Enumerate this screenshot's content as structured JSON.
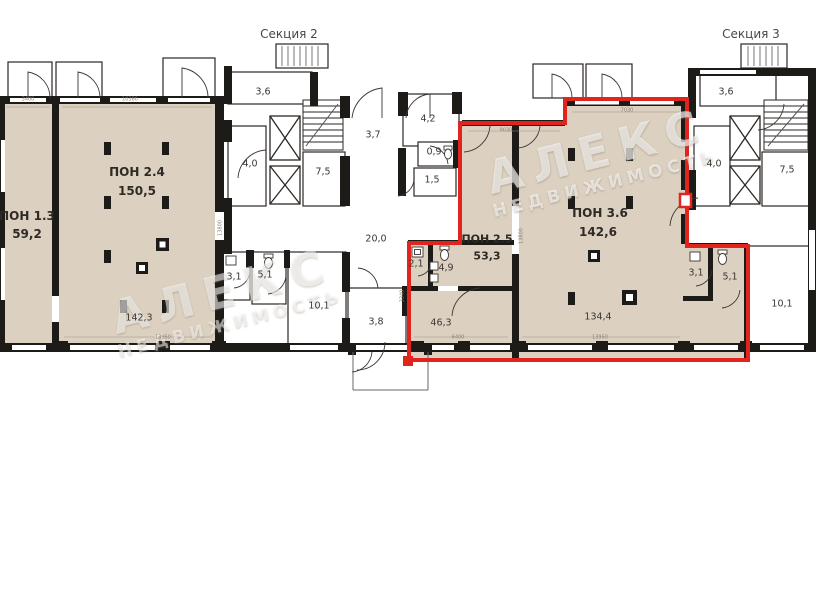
{
  "sections": {
    "section2": "Секция 2",
    "section3": "Секция 3"
  },
  "units": {
    "pon13": {
      "name": "ПОН 1.3",
      "area": "59,2"
    },
    "pon24": {
      "name": "ПОН 2.4",
      "area": "150,5",
      "inner_area": "142,3"
    },
    "pon25": {
      "name": "ПОН 2.5",
      "area": "53,3"
    },
    "pon36": {
      "name": "ПОН 3.6",
      "area": "142,6",
      "inner_area": "134,4"
    }
  },
  "rooms": {
    "s2_top": "3,6",
    "s2_lobby": "4,0",
    "s2_hall": "7,5",
    "s2_corridor": "3,7",
    "mid_room": "4,2",
    "mid_wc": "0,9",
    "mid_hall": "1,5",
    "corridor_20": "20,0",
    "left_wc1": "3,1",
    "left_wc2": "5,1",
    "left_room": "10,1",
    "vestibule": "3,8",
    "unit_hall": "2,1",
    "unit_wc": "4,9",
    "unit_room": "46,3",
    "right_wc1": "3,1",
    "right_wc2": "5,1",
    "right_room": "10,1",
    "s3_top": "3,6",
    "s3_lobby": "4,0",
    "s3_hall": "7,5"
  },
  "dimensions": [
    "3400",
    "10380",
    "9030",
    "7030",
    "6400",
    "13950",
    "13950",
    "13800",
    "13800",
    "3340"
  ],
  "watermark": {
    "line1": "АЛЕКС",
    "line2": "НЕДВИЖИМОСТЬ"
  },
  "colors": {
    "unit_fill": "#dcd1c0",
    "wall": "#1d1b18",
    "highlight": "#e2241f"
  }
}
